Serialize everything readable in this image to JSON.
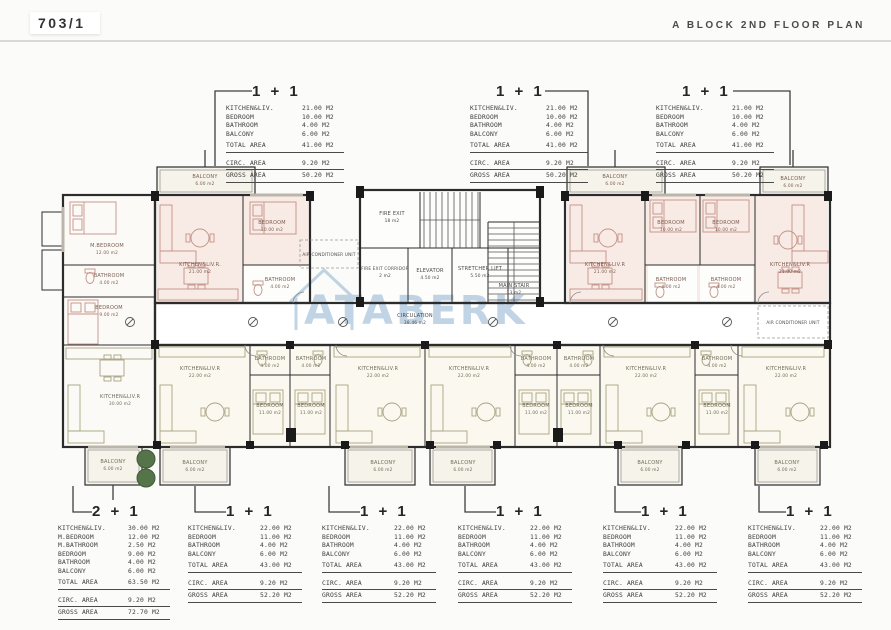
{
  "header": {
    "sheet_number": "703/1",
    "plan_title": "A BLOCK 2ND FLOOR PLAN"
  },
  "watermark": {
    "text": "ATABERK"
  },
  "tables": {
    "top": [
      {
        "unit_type": "1 + 1",
        "rows": [
          {
            "label": "KITCHEN&LIV.",
            "value": "21.00 M2"
          },
          {
            "label": "BEDROOM",
            "value": "10.00 M2"
          },
          {
            "label": "BATHROOM",
            "value": "4.00 M2"
          },
          {
            "label": "BALCONY",
            "value": "6.00 M2"
          }
        ],
        "total": {
          "label": "TOTAL AREA",
          "value": "41.00 M2"
        },
        "circ": {
          "label": "CIRC. AREA",
          "value": "9.20 M2"
        },
        "gross": {
          "label": "GROSS AREA",
          "value": "50.20 M2"
        }
      },
      {
        "unit_type": "1 + 1",
        "rows": [
          {
            "label": "KITCHEN&LIV.",
            "value": "21.00 M2"
          },
          {
            "label": "BEDROOM",
            "value": "10.00 M2"
          },
          {
            "label": "BATHROOM",
            "value": "4.00 M2"
          },
          {
            "label": "BALCONY",
            "value": "6.00 M2"
          }
        ],
        "total": {
          "label": "TOTAL AREA",
          "value": "41.00 M2"
        },
        "circ": {
          "label": "CIRC. AREA",
          "value": "9.20 M2"
        },
        "gross": {
          "label": "GROSS AREA",
          "value": "50.20 M2"
        }
      },
      {
        "unit_type": "1 + 1",
        "rows": [
          {
            "label": "KITCHEN&LIV.",
            "value": "21.00 M2"
          },
          {
            "label": "BEDROOM",
            "value": "10.00 M2"
          },
          {
            "label": "BATHROOM",
            "value": "4.00 M2"
          },
          {
            "label": "BALCONY",
            "value": "6.00 M2"
          }
        ],
        "total": {
          "label": "TOTAL AREA",
          "value": "41.00 M2"
        },
        "circ": {
          "label": "CIRC. AREA",
          "value": "9.20 M2"
        },
        "gross": {
          "label": "GROSS AREA",
          "value": "50.20 M2"
        }
      }
    ],
    "bottom": [
      {
        "unit_type": "2 + 1",
        "rows": [
          {
            "label": "KITCHEN&LIV.",
            "value": "30.00 M2"
          },
          {
            "label": "M.BEDROOM",
            "value": "12.00 M2"
          },
          {
            "label": "M.BATHROOM",
            "value": "2.50 M2"
          },
          {
            "label": "BEDROOM",
            "value": "9.00 M2"
          },
          {
            "label": "BATHROOM",
            "value": "4.00 M2"
          },
          {
            "label": "BALCONY",
            "value": "6.00 M2"
          }
        ],
        "total": {
          "label": "TOTAL AREA",
          "value": "63.50 M2"
        },
        "circ": {
          "label": "CIRC. AREA",
          "value": "9.20 M2"
        },
        "gross": {
          "label": "GROSS AREA",
          "value": "72.70 M2"
        }
      },
      {
        "unit_type": "1 + 1",
        "rows": [
          {
            "label": "KITCHEN&LIV.",
            "value": "22.00 M2"
          },
          {
            "label": "BEDROOM",
            "value": "11.00 M2"
          },
          {
            "label": "BATHROOM",
            "value": "4.00 M2"
          },
          {
            "label": "BALCONY",
            "value": "6.00 M2"
          }
        ],
        "total": {
          "label": "TOTAL AREA",
          "value": "43.00 M2"
        },
        "circ": {
          "label": "CIRC. AREA",
          "value": "9.20 M2"
        },
        "gross": {
          "label": "GROSS AREA",
          "value": "52.20 M2"
        }
      },
      {
        "unit_type": "1 + 1",
        "rows": [
          {
            "label": "KITCHEN&LIV.",
            "value": "22.00 M2"
          },
          {
            "label": "BEDROOM",
            "value": "11.00 M2"
          },
          {
            "label": "BATHROOM",
            "value": "4.00 M2"
          },
          {
            "label": "BALCONY",
            "value": "6.00 M2"
          }
        ],
        "total": {
          "label": "TOTAL AREA",
          "value": "43.00 M2"
        },
        "circ": {
          "label": "CIRC. AREA",
          "value": "9.20 M2"
        },
        "gross": {
          "label": "GROSS AREA",
          "value": "52.20 M2"
        }
      },
      {
        "unit_type": "1 + 1",
        "rows": [
          {
            "label": "KITCHEN&LIV.",
            "value": "22.00 M2"
          },
          {
            "label": "BEDROOM",
            "value": "11.00 M2"
          },
          {
            "label": "BATHROOM",
            "value": "4.00 M2"
          },
          {
            "label": "BALCONY",
            "value": "6.00 M2"
          }
        ],
        "total": {
          "label": "TOTAL AREA",
          "value": "43.00 M2"
        },
        "circ": {
          "label": "CIRC. AREA",
          "value": "9.20 M2"
        },
        "gross": {
          "label": "GROSS AREA",
          "value": "52.20 M2"
        }
      },
      {
        "unit_type": "1 + 1",
        "rows": [
          {
            "label": "KITCHEN&LIV.",
            "value": "22.00 M2"
          },
          {
            "label": "BEDROOM",
            "value": "11.00 M2"
          },
          {
            "label": "BATHROOM",
            "value": "4.00 M2"
          },
          {
            "label": "BALCONY",
            "value": "6.00 M2"
          }
        ],
        "total": {
          "label": "TOTAL AREA",
          "value": "43.00 M2"
        },
        "circ": {
          "label": "CIRC. AREA",
          "value": "9.20 M2"
        },
        "gross": {
          "label": "GROSS AREA",
          "value": "52.20 M2"
        }
      },
      {
        "unit_type": "1 + 1",
        "rows": [
          {
            "label": "KITCHEN&LIV.",
            "value": "22.00 M2"
          },
          {
            "label": "BEDROOM",
            "value": "11.00 M2"
          },
          {
            "label": "BATHROOM",
            "value": "4.00 M2"
          },
          {
            "label": "BALCONY",
            "value": "6.00 M2"
          }
        ],
        "total": {
          "label": "TOTAL AREA",
          "value": "43.00 M2"
        },
        "circ": {
          "label": "CIRC. AREA",
          "value": "9.20 M2"
        },
        "gross": {
          "label": "GROSS AREA",
          "value": "52.20 M2"
        }
      }
    ]
  },
  "plan": {
    "rooms": {
      "m_bedroom": {
        "name": "M.BEDROOM",
        "area": "12.00 m2"
      },
      "m_bathroom": {
        "name": "BATHROOM",
        "area": "4.00 m2"
      },
      "bedroom_left": {
        "name": "BEDROOM",
        "area": "9.00 m2"
      },
      "kitchen_2p1": {
        "name": "KITCHEN&LIV.R",
        "area": "30.00 m2"
      },
      "balcony_2p1": {
        "name": "BALCONY",
        "area": "6.00 m2"
      },
      "balcony_u1": {
        "name": "BALCONY",
        "area": "6.00 m2"
      },
      "kitchen_u1": {
        "name": "KITCHEN&LIV.R.",
        "area": "21.00 m2"
      },
      "bedroom_u1": {
        "name": "BEDROOM",
        "area": "10.00 m2"
      },
      "bathroom_u1": {
        "name": "BATHROOM",
        "area": "4.00 m2"
      },
      "ac_left": {
        "name": "AIR CONDITIONER UNIT"
      },
      "fire_exit": {
        "name": "FIRE EXIT",
        "area": "18 m2"
      },
      "fire_corridor": {
        "name": "FIRE EXIT CORRIDOR",
        "area": "2 m2"
      },
      "elevator": {
        "name": "ELEVATOR",
        "area": "4.50 m2"
      },
      "stretcher": {
        "name": "STRETCHER LIFT",
        "area": "5.50 m2"
      },
      "main_stair": {
        "name": "MAIN STAIR",
        "area": "13 m2"
      },
      "circulation": {
        "name": "CIRCULATION",
        "area": "38.46 m2"
      },
      "balcony_u2": {
        "name": "BALCONY",
        "area": "6.00 m2"
      },
      "kitchen_u2": {
        "name": "KITCHEN&LIV.R",
        "area": "21.00 m2"
      },
      "bedroom_u2": {
        "name": "BEDROOM",
        "area": "10.00 m2"
      },
      "bathroom_u2": {
        "name": "BATHROOM",
        "area": "4.00 m2"
      },
      "bedroom_u3": {
        "name": "BEDROOM",
        "area": "10.00 m2"
      },
      "bathroom_u3": {
        "name": "BATHROOM",
        "area": "4.00 m2"
      },
      "balcony_u3": {
        "name": "BALCONY",
        "area": "6.00 m2"
      },
      "kitchen_u3": {
        "name": "KITCHEN&LIV.R",
        "area": "21.00 m2"
      },
      "ac_right": {
        "name": "AIR CONDITIONER UNIT"
      },
      "kitchen_b1": {
        "name": "KITCHEN&LIV.R",
        "area": "22.00 m2"
      },
      "bathroom_b1": {
        "name": "BATHROOM",
        "area": "4.00 m2"
      },
      "bedroom_b1": {
        "name": "BEDROOM",
        "area": "11.00 m2"
      },
      "balcony_b1": {
        "name": "BALCONY",
        "area": "6.00 m2"
      },
      "bathroom_b2": {
        "name": "BATHROOM",
        "area": "4.00 m2"
      },
      "bedroom_b2": {
        "name": "BEDROOM",
        "area": "11.00 m2"
      },
      "kitchen_b2": {
        "name": "KITCHEN&LIV.R",
        "area": "22.00 m2"
      },
      "balcony_b2": {
        "name": "BALCONY",
        "area": "6.00 m2"
      },
      "kitchen_b3": {
        "name": "KITCHEN&LIV.R",
        "area": "22.00 m2"
      },
      "bathroom_b3": {
        "name": "BATHROOM",
        "area": "4.00 m2"
      },
      "bedroom_b3": {
        "name": "BEDROOM",
        "area": "11.00 m2"
      },
      "balcony_b3": {
        "name": "BALCONY",
        "area": "6.00 m2"
      },
      "bathroom_b4": {
        "name": "BATHROOM",
        "area": "4.00 m2"
      },
      "bedroom_b4": {
        "name": "BEDROOM",
        "area": "11.00 m2"
      },
      "kitchen_b4": {
        "name": "KITCHEN&LIV.R",
        "area": "22.00 m2"
      },
      "balcony_b4": {
        "name": "BALCONY",
        "area": "6.00 m2"
      },
      "bathroom_b5": {
        "name": "BATHROOM",
        "area": "4.00 m2"
      },
      "bedroom_b5": {
        "name": "BEDROOM",
        "area": "11.00 m2"
      },
      "kitchen_b5": {
        "name": "KITCHEN&LIV.R",
        "area": "22.00 m2"
      },
      "balcony_b5": {
        "name": "BALCONY",
        "area": "6.00 m2"
      }
    }
  }
}
